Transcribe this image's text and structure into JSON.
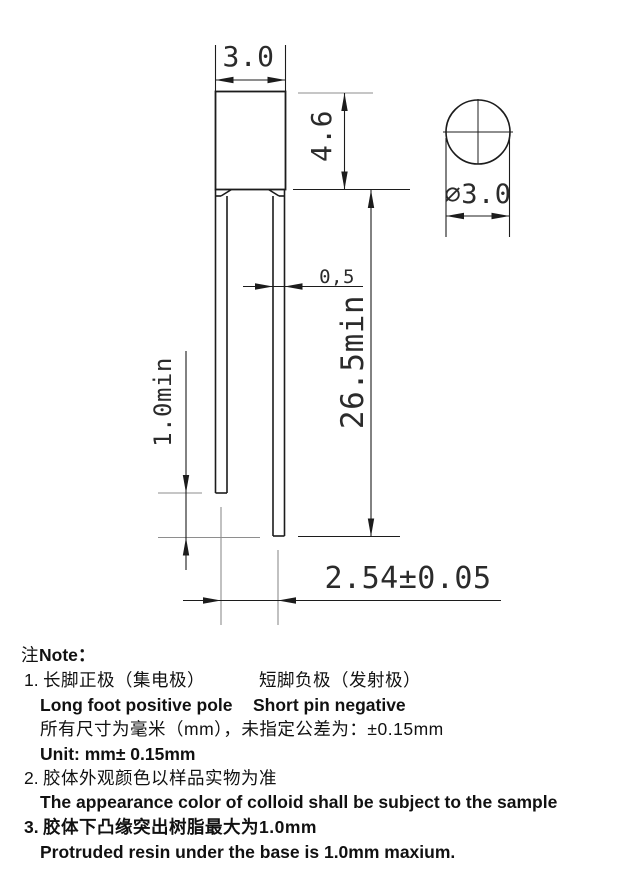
{
  "drawing": {
    "dim_body_width": "3.0",
    "dim_body_height": "4.6",
    "dim_pin_width": "0,5",
    "dim_long_pin": "26.5min",
    "dim_pin_diff": "1.0min",
    "dim_pitch": "2.54±0.05",
    "dim_diameter": "⌀3.0"
  },
  "notes": {
    "label_cn": "注",
    "label_en": "Note：",
    "n1_num": "1.",
    "n1_cn_left": "长脚正极（集电极）",
    "n1_cn_right": "短脚负极（发射极）",
    "n1_en_left": "Long foot positive pole",
    "n1_en_right": "Short pin negative",
    "n1_cn_dims": "所有尺寸为毫米（mm），未指定公差为：±0.15mm",
    "n1_unit": "Unit: mm± 0.15mm",
    "n2_num": "2.",
    "n2_cn": "胶体外观颜色以样品实物为准",
    "n2_en": "The appearance color of colloid shall be subject to the sample",
    "n3_num": "3.",
    "n3_cn": "胶体下凸缘突出树脂最大为1.0mm",
    "n3_en": "Protruded resin under the base is 1.0mm maxium."
  },
  "colors": {
    "line": "#1c1c1c",
    "extension_line": "#8e8e8e",
    "background": "#ffffff"
  }
}
